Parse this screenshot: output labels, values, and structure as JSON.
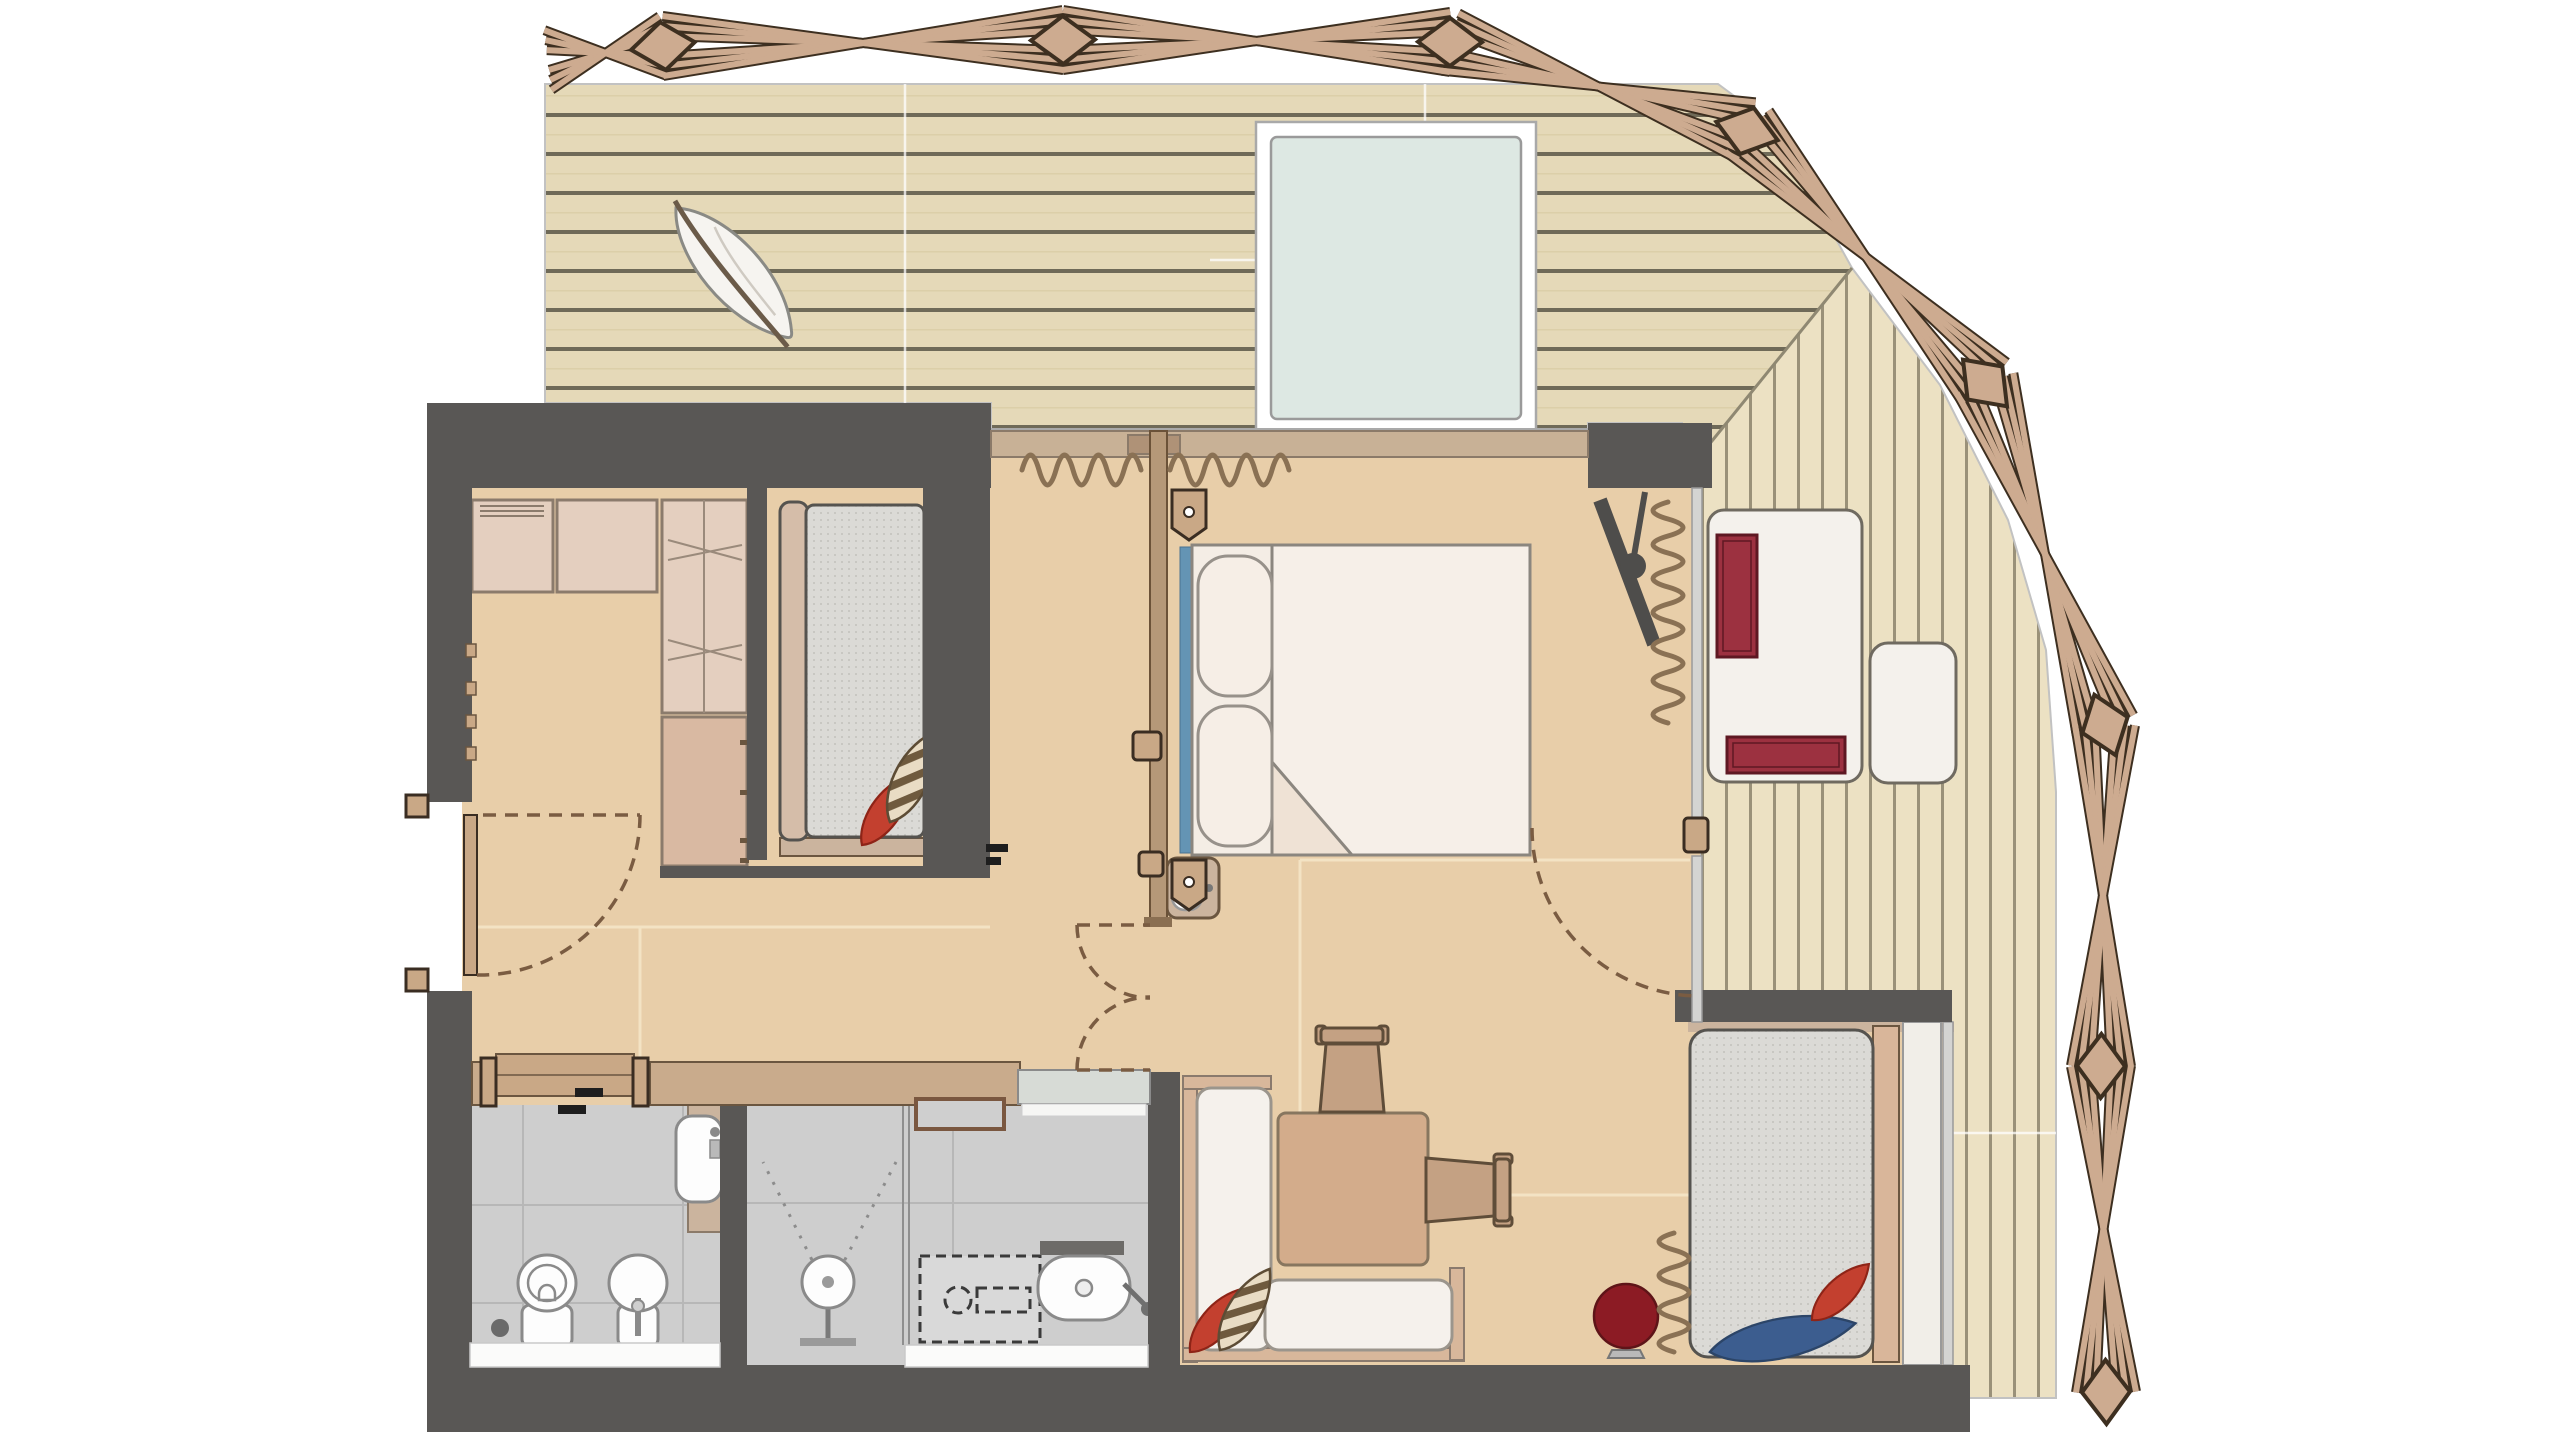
{
  "palette": {
    "wall": "#595755",
    "wood_floor": "#e8cea9",
    "deck_plank": "#e5d9b8",
    "deck_seam": "#6f6a58",
    "terrace_plank": "#ece1c3",
    "terrace_seam": "#9a9179",
    "tile": "#cecece",
    "glass": "#dde8e3",
    "truss_beam": "#cdab90",
    "truss_outline": "#3d2f20",
    "curtain": "#8a7154",
    "accent_red": "#c3402f",
    "cushion_red": "#9c3140",
    "accent_blue": "#3c5d8f",
    "headboard_blue": "#6494b4",
    "stool_red": "#8c1b24",
    "mattress": "#dbdad6",
    "bedding": "#f4ede5",
    "furniture_tan": "#d3ac8b",
    "cabinet": "#e4cfbf"
  },
  "plan": {
    "type": "apartment-floor-plan",
    "areas": [
      {
        "name": "roof-deck-top",
        "items": [
          "decorative-timber-truss",
          "horizontal-deck-boards",
          "skylight-glass-panel",
          "leaf-ornament"
        ]
      },
      {
        "name": "terrace-right",
        "items": [
          "vertical-deck-boards",
          "sun-lounger",
          "lounger-cushions",
          "side-table"
        ]
      },
      {
        "name": "bedroom-left",
        "items": [
          "cabinet-unit",
          "tall-wardrobe",
          "dresser",
          "single-bed",
          "red-cushion",
          "striped-cushion",
          "entry-door",
          "sliding-door-to-wc",
          "double-swing-door"
        ]
      },
      {
        "name": "bedroom-middle",
        "items": [
          "double-bed",
          "two-pillows",
          "duvet-with-fold",
          "blue-headboard-strip",
          "wall-tv",
          "window-curtains",
          "small-washbasin",
          "terrace-door"
        ]
      },
      {
        "name": "living-area",
        "items": [
          "corner-sofa",
          "red-cushion",
          "striped-cushion",
          "coffee-table",
          "chair-top",
          "chair-right",
          "red-ball-lamp"
        ]
      },
      {
        "name": "sleeping-alcove",
        "items": [
          "single-bed",
          "red-cushion",
          "blue-throw",
          "side-bench",
          "curtain"
        ]
      },
      {
        "name": "bathroom",
        "items": [
          "shower",
          "spray-symbol",
          "glass-partition",
          "dashed-bench",
          "bathtub",
          "shelf",
          "wall-niche",
          "interior-window",
          "white-threshold"
        ]
      },
      {
        "name": "wc-room",
        "items": [
          "toilet",
          "bidet",
          "washbasin-counter",
          "floor-drain",
          "white-threshold"
        ]
      }
    ]
  }
}
